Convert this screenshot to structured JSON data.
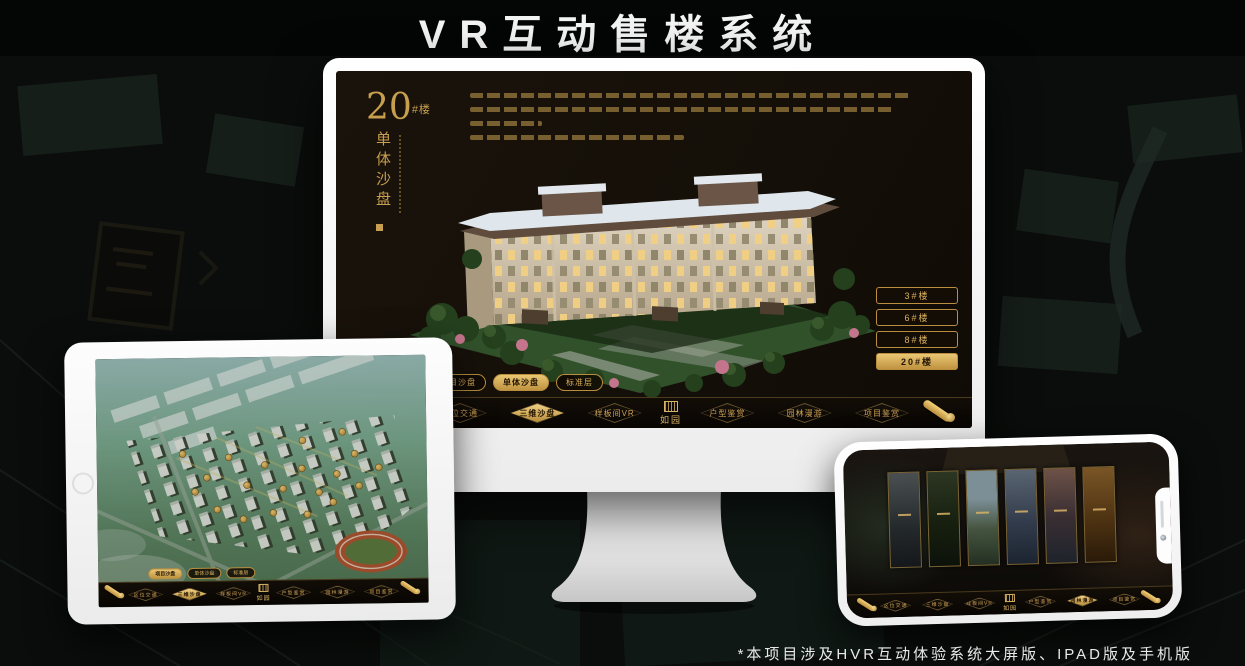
{
  "page": {
    "title": "VR互动售楼系统",
    "footnote": "*本项目涉及HVR互动体验系统大屏版、IPAD版及手机版"
  },
  "colors": {
    "gold": "#c9a050",
    "gold_active": "#e8c577",
    "screen_bg": "#17110a"
  },
  "brand": {
    "logo_text": "如园"
  },
  "nav": {
    "left": [
      "区位交通",
      "三维沙盘",
      "样板间VR"
    ],
    "right": [
      "户型鉴赏",
      "园林漫游",
      "项目鉴赏"
    ]
  },
  "sub_tabs": [
    "项目沙盘",
    "单体沙盘",
    "标准层"
  ],
  "desktop": {
    "heading": {
      "number": "20",
      "suffix": "#楼",
      "subtitle": "单体沙盘"
    },
    "building_buttons": [
      "3#楼",
      "6#楼",
      "8#楼",
      "20#楼"
    ],
    "active_building": "20#楼",
    "active_sub_tab": "单体沙盘",
    "active_nav": "三维沙盘"
  },
  "tablet": {
    "active_sub_tab": "项目沙盘",
    "active_nav": "三维沙盘"
  },
  "phone": {
    "active_nav": "园林漫游",
    "gallery_panels": [
      "interior-hall",
      "courtyard",
      "landscape",
      "building-exterior",
      "pavilion",
      "display-shelf"
    ]
  }
}
